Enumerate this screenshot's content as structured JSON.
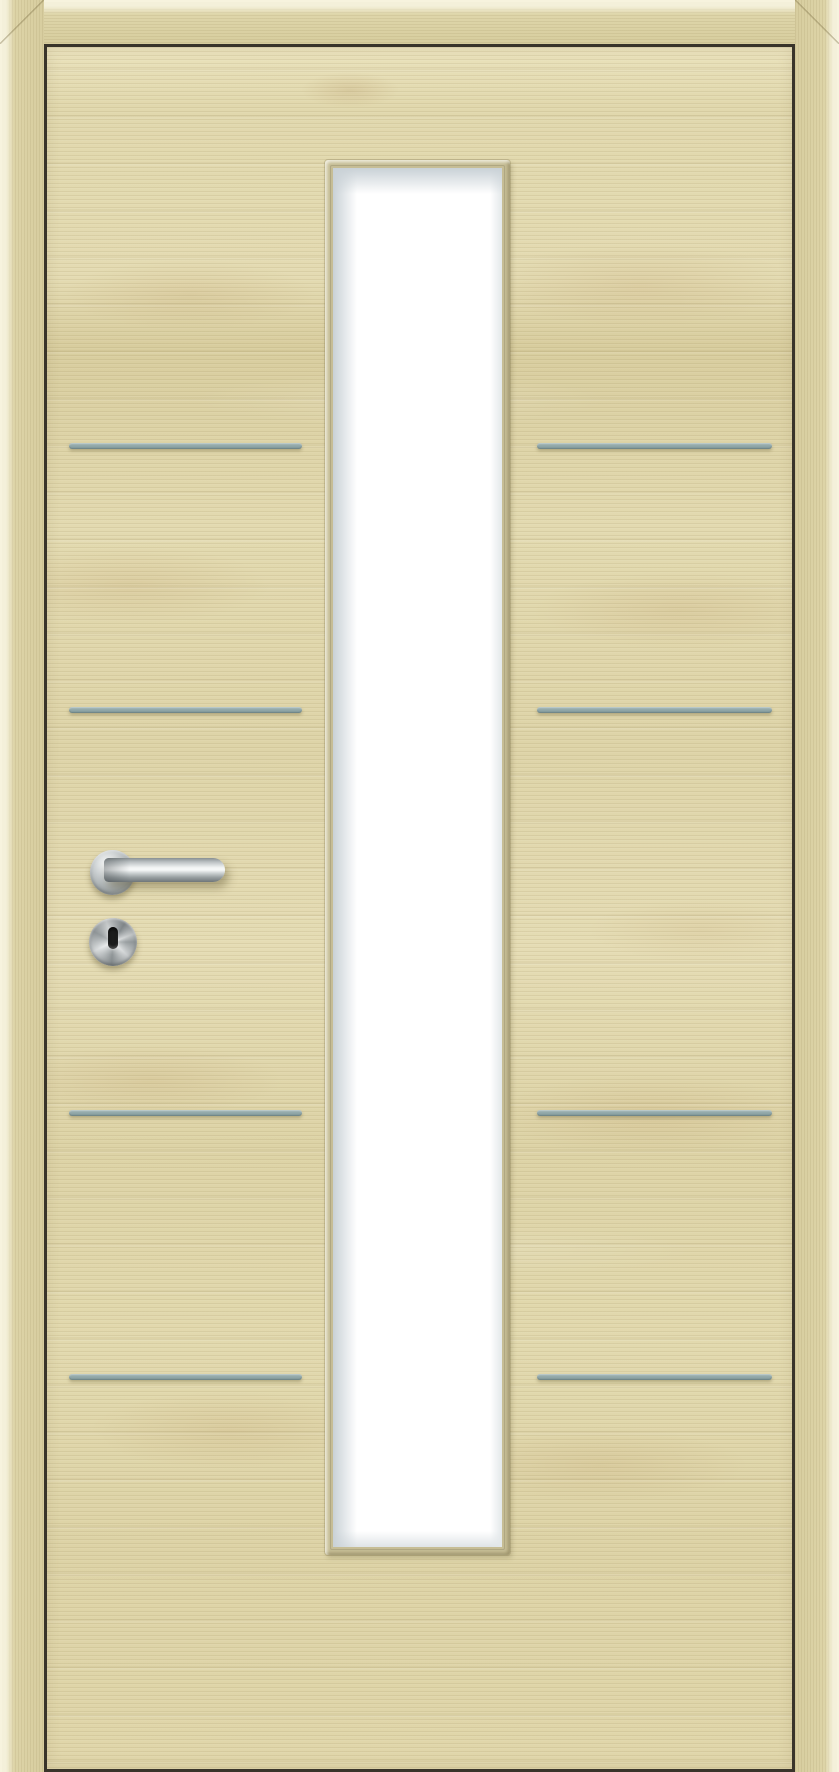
{
  "subject": "Interior door product photo: light maple laminate door leaf with surrounding maple casing, centered full-height narrow glazing with white frosted glass and wooden glazing bead, four pairs of horizontal satin-aluminium inlay strips, stainless-steel lever handle on round rosette and round key escutcheon with keyhole",
  "colors": {
    "gap": "#39342a",
    "frame_wood": "#dcd3a6",
    "frame_edge": "#f4f0da",
    "leaf_base": "#e1d8ad",
    "leaf_light": "#eae2bc",
    "leaf_dark": "#d8cd9e",
    "grain_line": "rgba(122,104,56,0.10)",
    "knot": "rgba(182,146,92,0.16)",
    "bead": "#c6bd95",
    "bead_dark": "#9d9572",
    "glass": "#ffffff",
    "glass_edge": "#c9d1d6",
    "inlay_light": "#a5b8b8",
    "inlay_dark": "#82999a",
    "steel_bright": "#f2f4f4",
    "steel_mid": "#9aa1a3",
    "steel_dark": "#6f7679",
    "keyhole": "#1b1c1c",
    "hardware_shadow": "rgba(95,85,50,0.42)"
  },
  "layout": {
    "glass-panel": {
      "x": 325,
      "y": 160,
      "width": 185,
      "height": 1395
    },
    "handle-rosette": {
      "x": 90,
      "y": 850,
      "width": 45,
      "height": 45
    },
    "door-lever": {
      "x": 104,
      "y": 858,
      "width": 121,
      "height": 24
    },
    "key-escutcheon": {
      "x": 89,
      "y": 918,
      "width": 48,
      "height": 48
    },
    "keyhole": {
      "x": 108,
      "y": 927,
      "width": 10,
      "height": 22
    }
  },
  "inlays": {
    "rows_y_center": [
      446,
      710,
      1113,
      1377
    ],
    "height": 6,
    "left": {
      "x": 69,
      "width": 233
    },
    "right": {
      "x": 537,
      "width": 235
    }
  }
}
